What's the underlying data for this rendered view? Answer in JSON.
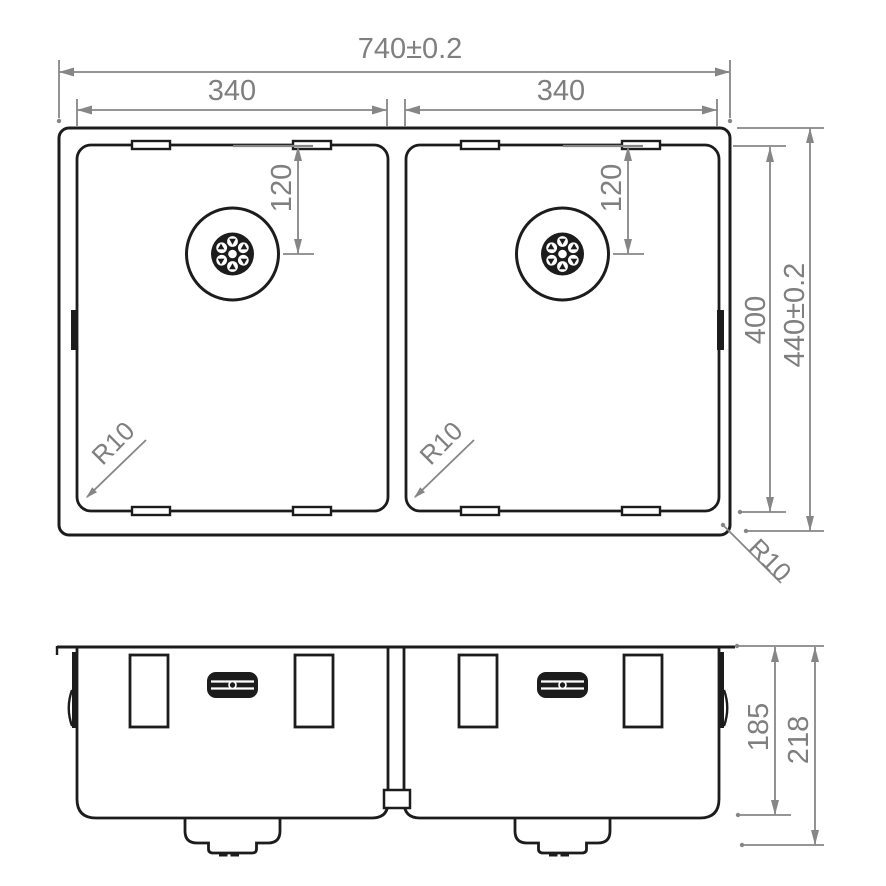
{
  "meta": {
    "description": "Technical dimension drawing of a double-bowl undermount sink: top view and front section view"
  },
  "dims": {
    "overall_width": "740±0.2",
    "bowl_width_left": "340",
    "bowl_width_right": "340",
    "drain_offset_left": "120",
    "drain_offset_right": "120",
    "inner_length": "400",
    "overall_length": "440±0.2",
    "bowl_radius_left": "R10",
    "bowl_radius_right": "R10",
    "outer_radius": "R10",
    "bowl_depth": "185",
    "overall_depth": "218"
  },
  "colors": {
    "line": "#1c1c1c",
    "dimension": "#868686",
    "text": "#7f7f7f",
    "background": "#ffffff"
  }
}
